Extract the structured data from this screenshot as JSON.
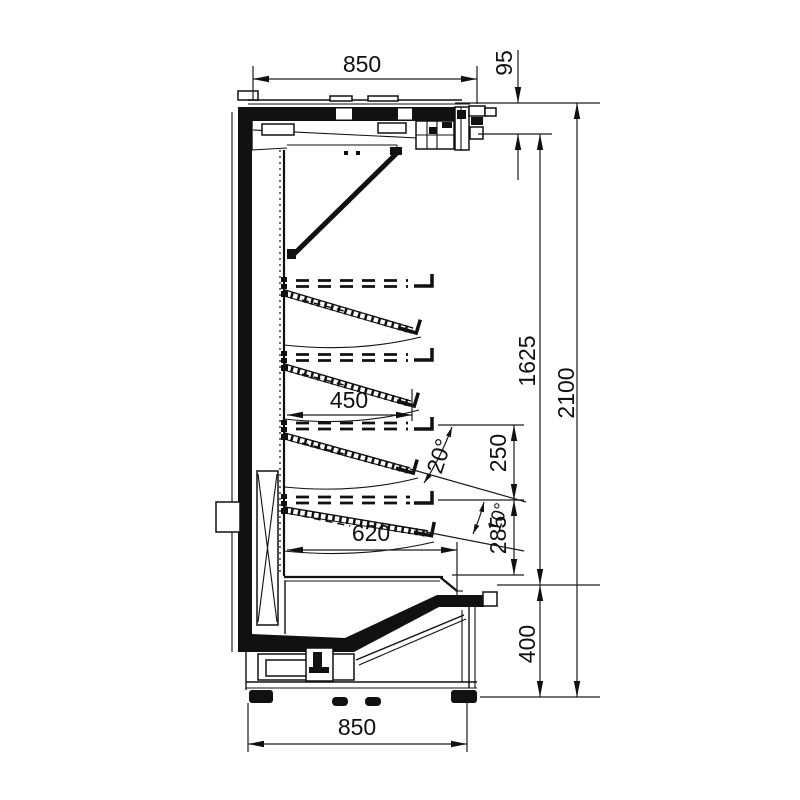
{
  "colors": {
    "ink": "#111111",
    "paper": "#ffffff"
  },
  "dims": {
    "top_width": "850",
    "canopy_front_height": "95",
    "shelf_depth": "450",
    "shelf_max_angle": "20°",
    "shelf_spacing_upper": "250",
    "shelf_min_angle": "10°",
    "shelf_spacing_lower": "285",
    "bottom_shelf_depth": "620",
    "display_opening_height": "1625",
    "overall_height": "2100",
    "base_height": "400",
    "bottom_width": "850"
  }
}
